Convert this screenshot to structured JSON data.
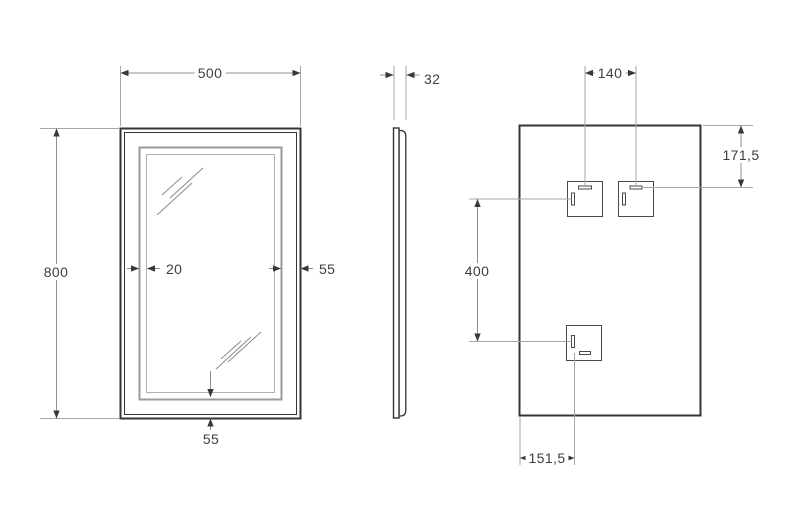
{
  "drawing": {
    "front_view": {
      "width": "500",
      "height": "800",
      "led_band_width": "20",
      "band_inset_side": "55",
      "band_inset_bottom": "55"
    },
    "side_view": {
      "depth": "32"
    },
    "back_view": {
      "bracket_horizontal_spacing": "140",
      "bracket_top_offset": "171,5",
      "bracket_vertical_spacing": "400",
      "bracket_left_offset": "151,5"
    },
    "colors": {
      "outline": "#343434",
      "dimension_lines": "#8f8f8f",
      "led_band": "#9a9a9a"
    }
  }
}
